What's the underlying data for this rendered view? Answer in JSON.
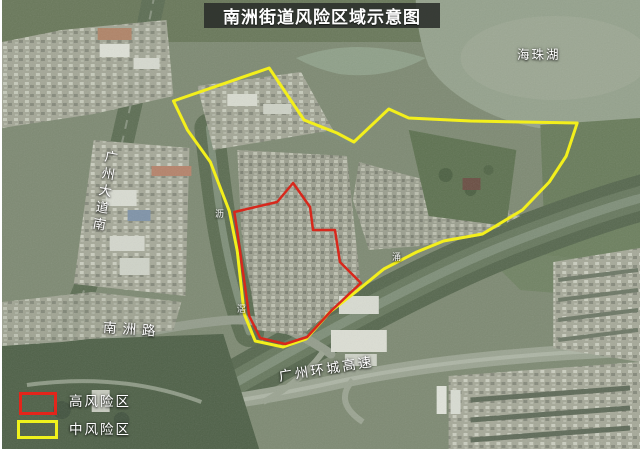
{
  "title": "南洲街道风险区域示意图",
  "legend": {
    "high_risk": {
      "label": "高风险区",
      "color": "#e3251b"
    },
    "medium_risk": {
      "label": "中风险区",
      "color": "#eff11c"
    }
  },
  "map_labels": {
    "lake": "海珠湖",
    "avenue": "广州大道南",
    "nanzhou_road": "南洲路",
    "expressway": "广州环城高速",
    "creek_char_1": "沥",
    "creek_char_2": "滘",
    "creek_char_3": "涌"
  },
  "zones": {
    "medium_risk_points": "172,101 268,68 303,120 336,133 353,142 388,109 408,118 470,121 577,123 566,156 549,182 522,210 482,234 443,241 416,252 383,269 356,291 329,312 305,339 282,347 254,341 243,314 236,251 228,211 209,162 186,130",
    "high_risk_points": "233,212 276,202 292,183 309,207 312,230 334,230 339,262 360,283 331,310 306,337 284,344 259,338 248,316 240,260 236,231"
  }
}
